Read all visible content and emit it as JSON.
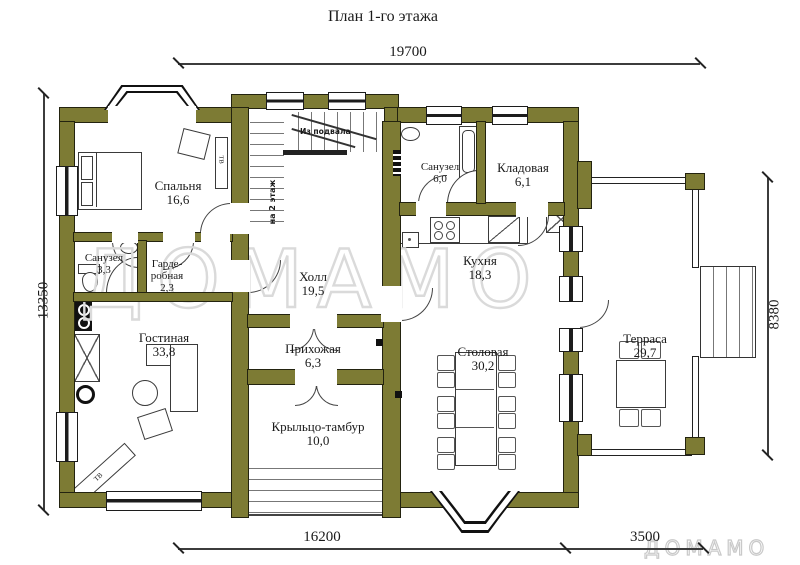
{
  "title": "План 1-го этажа",
  "watermark": {
    "large": "ДОМАМО",
    "small": "ДОМАМО"
  },
  "colors": {
    "wall": "#7d7b34",
    "line": "#1c1c1c",
    "watermark": "#dadada",
    "background": "#ffffff"
  },
  "dimensions": {
    "top": "19700",
    "left": "13350",
    "right": "8380",
    "bottom_left": "16200",
    "bottom_right": "3500"
  },
  "rooms": [
    {
      "id": "bedroom",
      "name": "Спальня",
      "area": "16,6"
    },
    {
      "id": "bath-small",
      "name": "Санузел",
      "area": "3,3"
    },
    {
      "id": "wardrobe",
      "name": "Гарде-\nробная",
      "area": "2,3"
    },
    {
      "id": "bath-big",
      "name": "Санузел",
      "area": "6,0"
    },
    {
      "id": "storage",
      "name": "Кладовая",
      "area": "6,1"
    },
    {
      "id": "kitchen",
      "name": "Кухня",
      "area": "18,3"
    },
    {
      "id": "hall",
      "name": "Холл",
      "area": "19,5"
    },
    {
      "id": "living",
      "name": "Гостиная",
      "area": "33,8"
    },
    {
      "id": "entry",
      "name": "Прихожая",
      "area": "6,3"
    },
    {
      "id": "porch",
      "name": "Крыльцо-тамбур",
      "area": "10,0"
    },
    {
      "id": "dining",
      "name": "Столовая",
      "area": "30,2"
    },
    {
      "id": "terrace",
      "name": "Терраса",
      "area": "29,7"
    }
  ],
  "annotations": {
    "from_basement": "Из подвала",
    "to_second_floor": "на 2 этаж",
    "tv": "ТВ"
  }
}
